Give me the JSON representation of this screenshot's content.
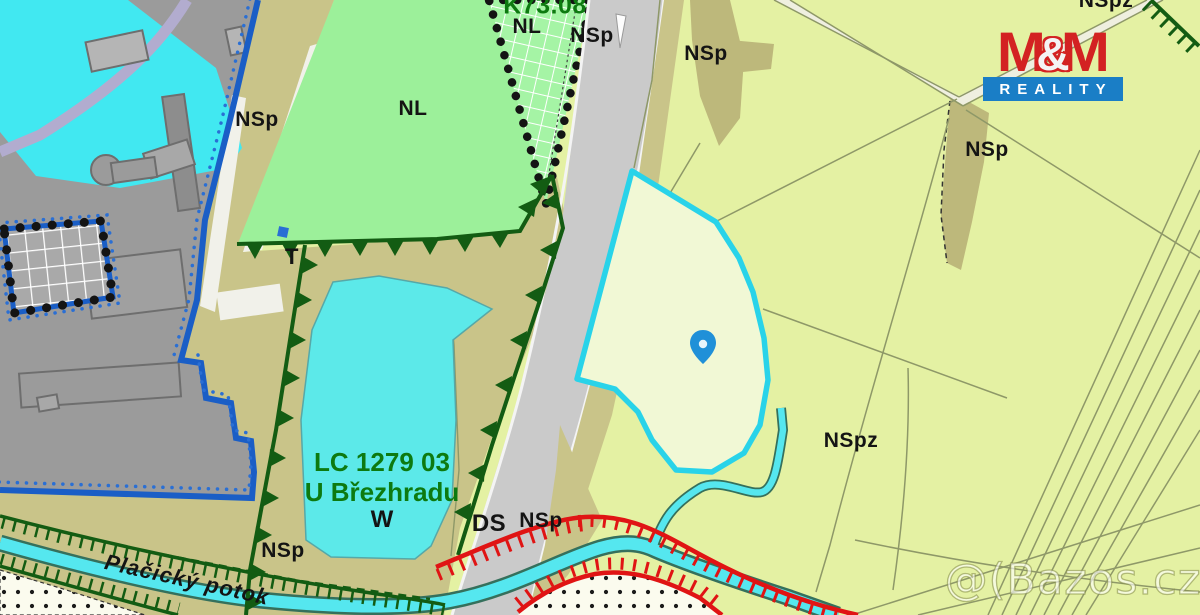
{
  "map": {
    "zone_labels": {
      "k73": "K73.08",
      "nl_top": "NL",
      "nl_main": "NL",
      "nspz_top": "NSpz",
      "nspz_main": "NSpz",
      "t": "T",
      "ds": "DS",
      "lc_code": "LC 1279 03",
      "lc_name": "U Březhradu",
      "lc_w": "W",
      "stream_name": "Plačický potok",
      "nsp": [
        "NSp",
        "NSp",
        "NSp",
        "NSp",
        "NSp",
        "NSp"
      ]
    },
    "colors": {
      "plot_outline_cyan": "#29d3e9",
      "water_cyan": "#41e8f1",
      "plot_fill_cyan": "#5ce9e9",
      "zone_khaki": "#c9c489",
      "zone_khaki_dark": "#bdb87b",
      "zone_green": "#9cf09a",
      "zone_pale_green": "#e4f1a3",
      "urban_gray": "#9b9b9b",
      "road_gray": "#cacaca",
      "boundary_blue": "#1a5ec6",
      "eco_dark_green": "#135c13",
      "hazard_red": "#e01414",
      "pin_blue": "#2090d8"
    }
  },
  "branding": {
    "logo_m_left": "M",
    "logo_ampersand": "&",
    "logo_m_right": "M",
    "logo_subtitle": "REALITY",
    "watermark": "@(Bazos.cz"
  }
}
